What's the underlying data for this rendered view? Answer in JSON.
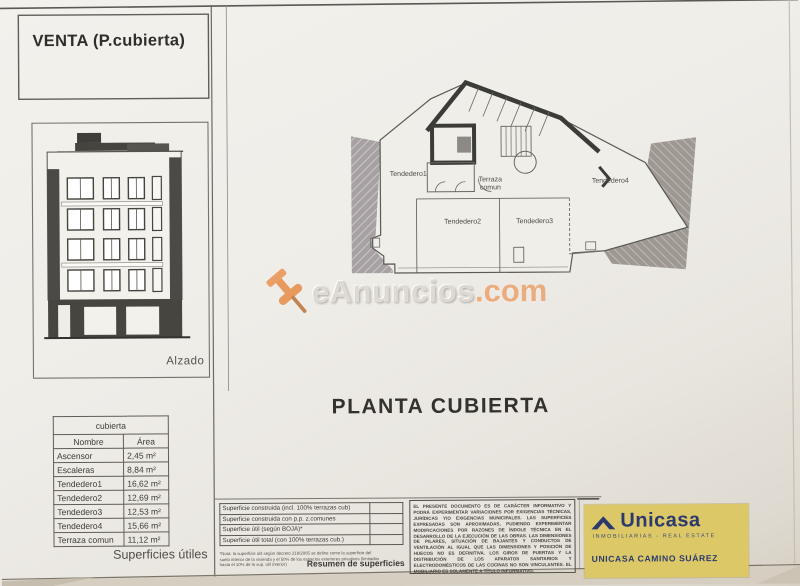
{
  "title_box": {
    "label": "VENTA (P.cubierta)"
  },
  "elevation": {
    "caption": "Alzado"
  },
  "plan": {
    "title": "PLANTA CUBIERTA",
    "rooms": {
      "tendedero1": "Tendedero1",
      "terraza_comun": "Terraza comun",
      "tendedero4": "Tendedero4",
      "tendedero2": "Tendedero2",
      "tendedero3": "Tendedero3"
    }
  },
  "areas_table": {
    "title": "cubierta",
    "columns": [
      "Nombre",
      "Área"
    ],
    "rows": [
      [
        "Ascensor",
        "2,45 m²"
      ],
      [
        "Escaleras",
        "8,84 m²"
      ],
      [
        "Tendedero1",
        "16,62 m²"
      ],
      [
        "Tendedero2",
        "12,69 m²"
      ],
      [
        "Tendedero3",
        "12,53 m²"
      ],
      [
        "Tendedero4",
        "15,66 m²"
      ],
      [
        "Terraza comun",
        "11,12 m²"
      ]
    ],
    "caption": "Superficies útiles"
  },
  "summary_table": {
    "rows": [
      "Superficie construida (incl. 100% terrazas cub)",
      "Superficie construida con p.p. z.comunes",
      "Superficie útil (según BOJA)*",
      "Superficie útil total (con 100% terrazas cub.)"
    ],
    "footnote": "*Nota: la superficie útil según decreto 218/2005 se define como la superficie del suelo interior de la vivienda y el 50% de los espacios exteriores privativos (limitados hasta el 10% de la sup. útil interior)",
    "caption": "Resumen de superficies"
  },
  "disclaimer": "EL PRESENTE DOCUMENTO ES DE CARÁCTER INFORMATIVO Y PODRÁ EXPERIMENTAR VARIACIONES POR EXIGENCIAS TÉCNICAS, JURÍDICAS Y/O EXIGENCIAS MUNICIPALES. LAS SUPERFICIES EXPRESADAS SON APROXIMADAS, PUDIENDO EXPERIMENTAR MODIFICACIONES POR RAZONES DE ÍNDOLE TÉCNICA EN EL DESARROLLO DE LA EJECUCIÓN DE LAS OBRAS. LAS DIMENSIONES DE PILARES, SITUACIÓN DE BAJANTES Y CONDUCTOS DE VENTILACIÓN AL IGUAL QUE LAS DIMENSIONES Y POSICIÓN DE HUECOS NO ES DEFINITIVA. LOS GIROS DE PUERTAS Y LA DISTRIBUCIÓN DE LOS APARATOS SANITARIOS Y ELECTRODOMÉSTICOS DE LAS COCINAS NO SON VINCULANTES. EL MOBILIARIO ES SOLAMENTE A TÍTULO INFORMATIVO.",
  "agency": {
    "brand": "Unicasa",
    "tagline": "INMOBILIARIAS - REAL ESTATE",
    "office": "UNICASA CAMINO SUÁREZ",
    "brand_color": "#2b3a6e",
    "card_color": "#dcc867"
  },
  "watermark": {
    "name": "eAnuncios",
    "tld": ".com",
    "accent_color": "#ea9a60"
  }
}
